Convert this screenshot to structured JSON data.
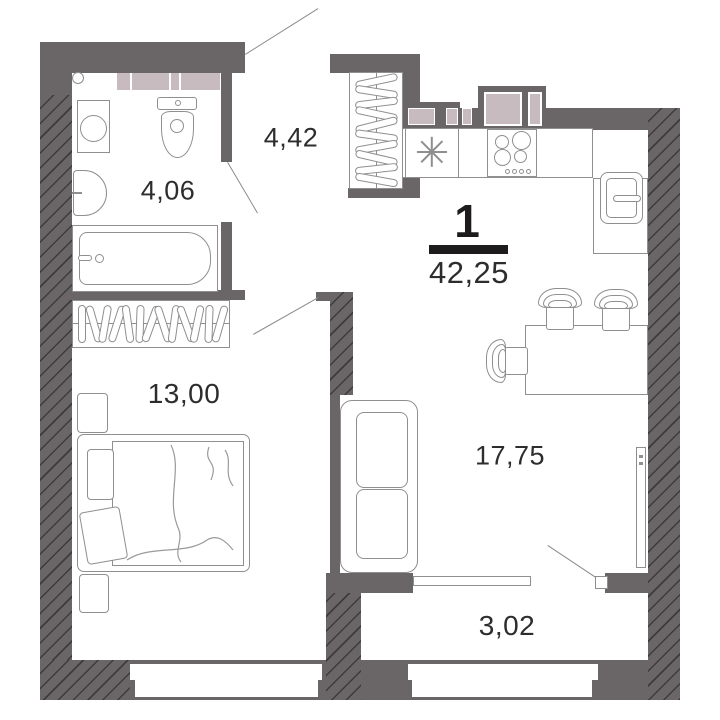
{
  "plan": {
    "rooms_count_label": "1",
    "total_area_label": "42,25",
    "rooms": [
      {
        "name": "bathroom",
        "area_label": "4,06"
      },
      {
        "name": "hallway",
        "area_label": "4,42"
      },
      {
        "name": "bedroom",
        "area_label": "13,00"
      },
      {
        "name": "kitchen-living-room",
        "area_label": "17,75"
      },
      {
        "name": "balcony",
        "area_label": "3,02"
      }
    ],
    "colors": {
      "wall": "#6a6667",
      "cabinet": "#c8bbbf",
      "outline": "#8f8f8f",
      "text": "#2e2c2d",
      "accent": "#1d1b1b"
    },
    "fixtures": [
      "washing-machine",
      "toilet",
      "wash-basin",
      "bathtub",
      "hallway-wardrobe",
      "kitchen-sink",
      "stove",
      "fridge",
      "dining-table",
      "chairs",
      "sofa",
      "tv",
      "bedroom-wardrobe",
      "bed",
      "nightstands",
      "entrance-door",
      "bathroom-door",
      "bedroom-door",
      "balcony-door",
      "windows"
    ]
  }
}
